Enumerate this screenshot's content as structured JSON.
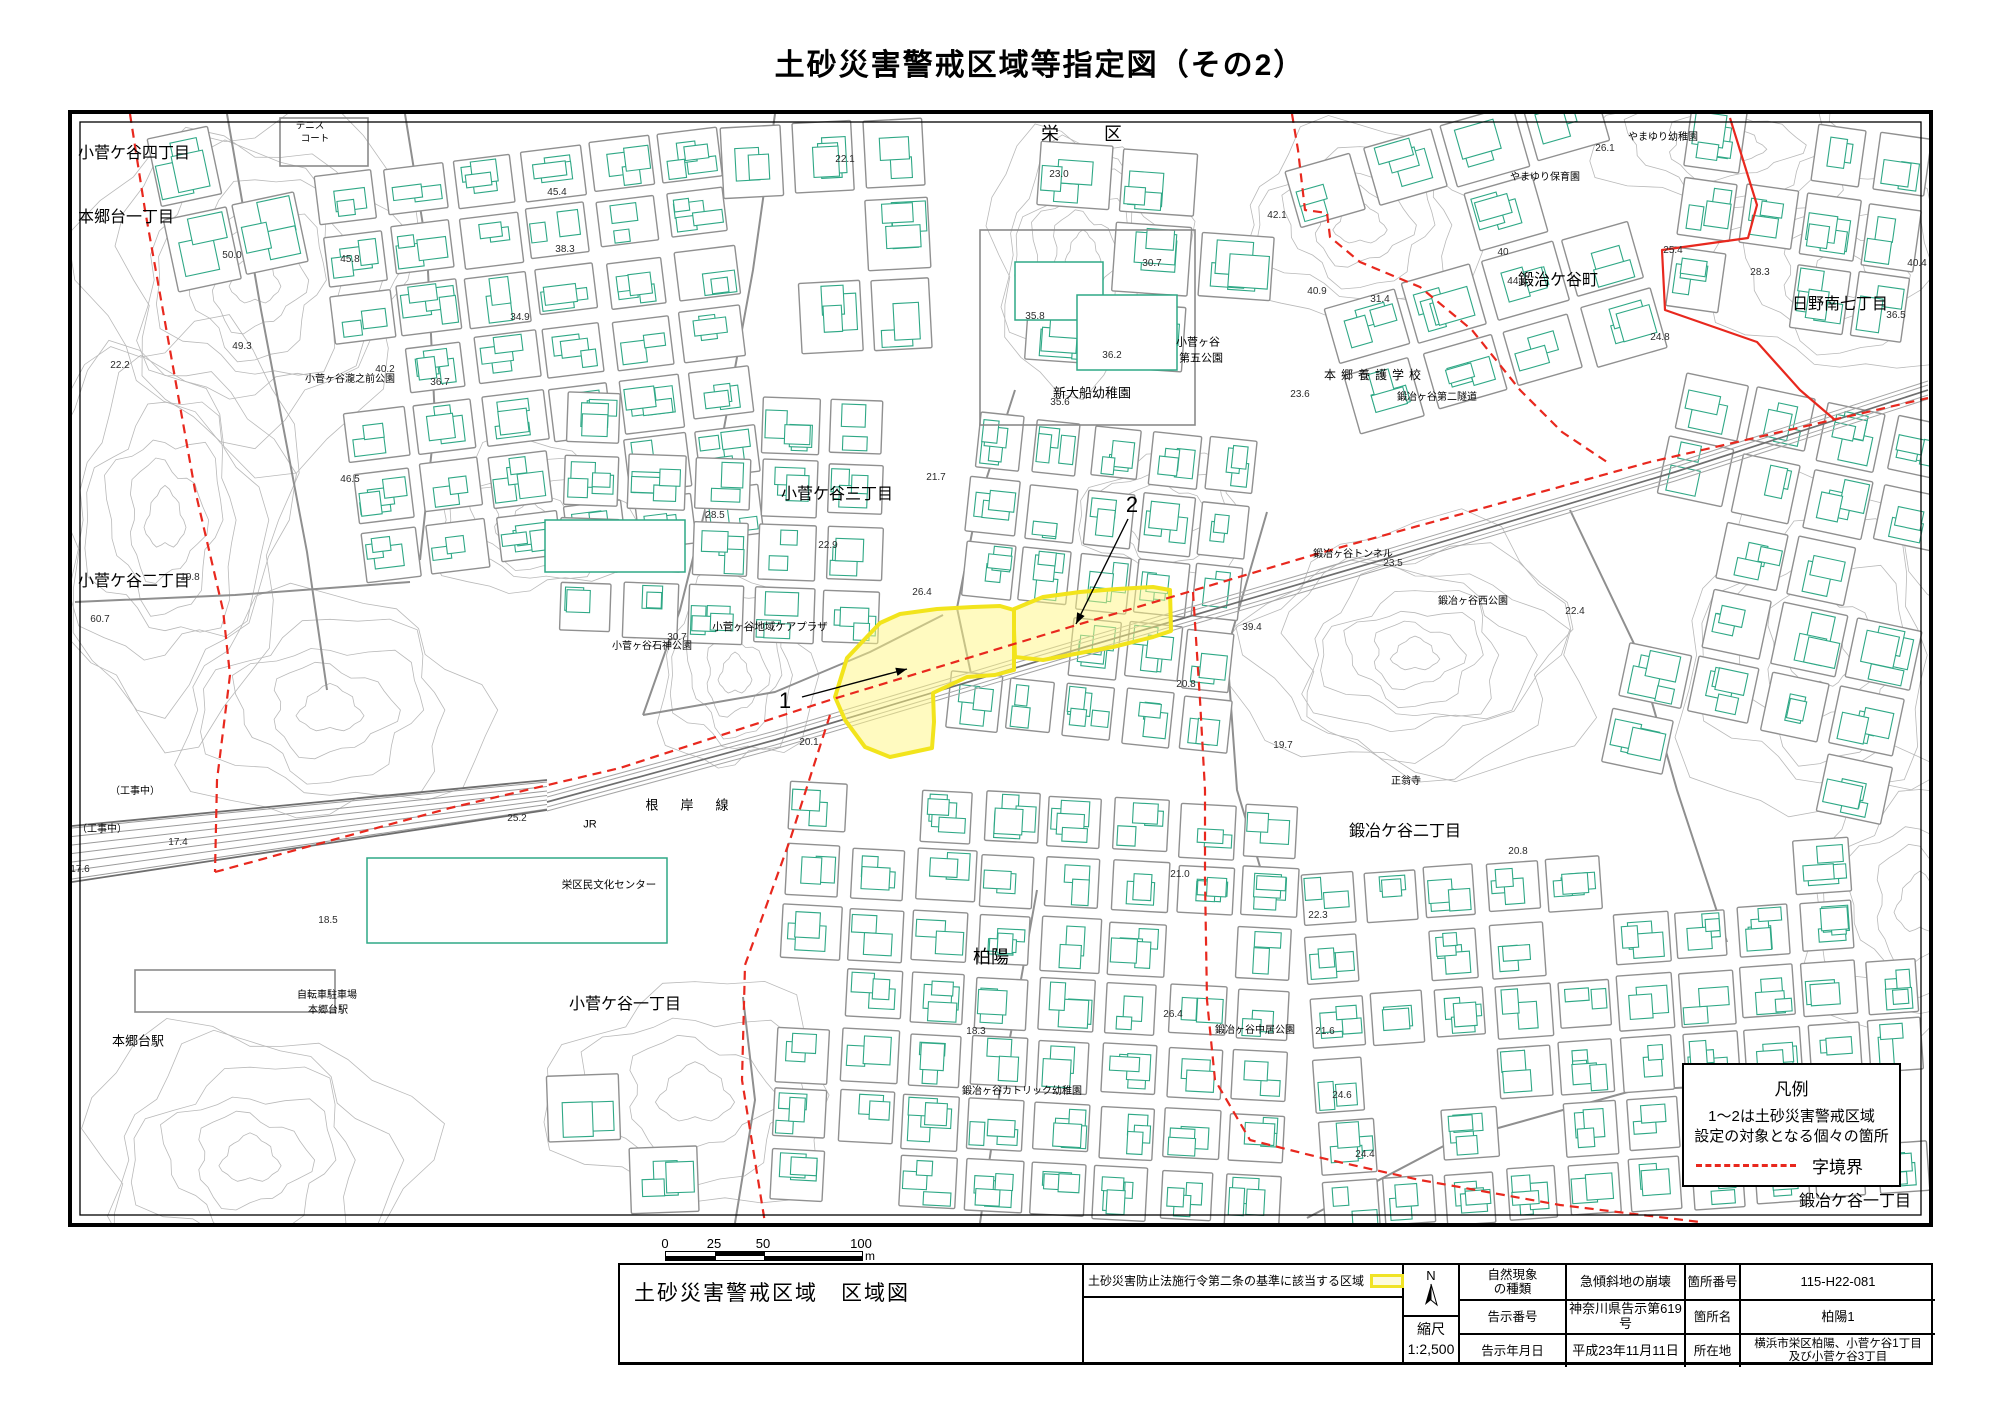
{
  "page_title": "土砂災害警戒区域等指定図（その2）",
  "colors": {
    "building": "#2fa886",
    "road": "#8f8f8f",
    "contour": "#b9b9b9",
    "rail": "#6e6e6e",
    "boundary_red": "#e8281e",
    "zone_fill": "rgba(255,246,130,0.5)",
    "zone_border": "#f2e41c"
  },
  "legend": {
    "title": "凡例",
    "line1": "1～2は土砂災害警戒区域",
    "line2": "設定の対象となる個々の箇所",
    "boundary_label": "字境界"
  },
  "scalebar": {
    "ticks": [
      "0",
      "25",
      "50",
      "100"
    ],
    "unit": "m"
  },
  "titleblock": {
    "map_title": "土砂災害警戒区域　区域図",
    "criteria": "土砂災害防止法施行令第二条の基準に該当する区域",
    "north": "N",
    "scale_label": "縮尺",
    "scale_value": "1:2,500",
    "rows": [
      {
        "k1": "自然現象\nの種類",
        "v1": "急傾斜地の崩壊",
        "k2": "箇所番号",
        "v2": "115-H22-081"
      },
      {
        "k1": "告示番号",
        "v1": "神奈川県告示第619号",
        "k2": "箇所名",
        "v2": "柏陽1"
      },
      {
        "k1": "告示年月日",
        "v1": "平成23年11月11日",
        "k2": "所在地",
        "v2": "横浜市栄区柏陽、小菅ケ谷1丁目\n及び小菅ケ谷3丁目"
      }
    ]
  },
  "map": {
    "area_labels": [
      {
        "t": "小菅ケ谷四丁目",
        "x": 6,
        "y": 40,
        "s": 16,
        "a": "l"
      },
      {
        "t": "本郷台一丁目",
        "x": 6,
        "y": 104,
        "s": 16,
        "a": "l"
      },
      {
        "t": "小菅ケ谷二丁目",
        "x": 6,
        "y": 468,
        "s": 16,
        "a": "l"
      },
      {
        "t": "小菅ケ谷三丁目",
        "x": 765,
        "y": 381,
        "s": 16
      },
      {
        "t": "栄区",
        "x": 1032,
        "y": 20,
        "s": 18,
        "ls": 45
      },
      {
        "t": "鍛治ケ谷町",
        "x": 1486,
        "y": 167,
        "s": 16
      },
      {
        "t": "日野南七丁目",
        "x": 1768,
        "y": 191,
        "s": 16
      },
      {
        "t": "鍛冶ケ谷二丁目",
        "x": 1333,
        "y": 718,
        "s": 16
      },
      {
        "t": "柏陽",
        "x": 919,
        "y": 843,
        "s": 18
      },
      {
        "t": "小菅ケ谷一丁目",
        "x": 553,
        "y": 891,
        "s": 16
      },
      {
        "t": "鍛冶ケ谷一丁目",
        "x": 1783,
        "y": 1088,
        "s": 16
      },
      {
        "t": "本郷台駅",
        "x": 66,
        "y": 927,
        "s": 13
      }
    ],
    "spot_labels": [
      {
        "t": "テニス",
        "x": 238,
        "y": 12,
        "s": 9.5
      },
      {
        "t": "コート",
        "x": 243,
        "y": 25,
        "s": 9.5
      },
      {
        "t": "小菅ヶ谷瀧之前公園",
        "x": 278,
        "y": 266,
        "s": 10
      },
      {
        "t": "小菅ヶ谷地域ケアプラザ",
        "x": 698,
        "y": 513,
        "s": 10.5
      },
      {
        "t": "小菅ヶ谷石神公園",
        "x": 580,
        "y": 533,
        "s": 10
      },
      {
        "t": "新大船幼稚園",
        "x": 1020,
        "y": 279,
        "s": 13
      },
      {
        "t": "小菅ヶ谷",
        "x": 1126,
        "y": 229,
        "s": 11
      },
      {
        "t": "第五公園",
        "x": 1129,
        "y": 245,
        "s": 11
      },
      {
        "t": "本郷養護学校",
        "x": 1303,
        "y": 261,
        "s": 12,
        "ls": 5
      },
      {
        "t": "鍛冶ヶ谷第二隧道",
        "x": 1365,
        "y": 284,
        "s": 10
      },
      {
        "t": "やまゆり幼稚園",
        "x": 1591,
        "y": 24,
        "s": 10
      },
      {
        "t": "やまゆり保育園",
        "x": 1473,
        "y": 64,
        "s": 10
      },
      {
        "t": "鍛冶ヶ谷トンネル",
        "x": 1281,
        "y": 441,
        "s": 10
      },
      {
        "t": "鍛冶ヶ谷西公園",
        "x": 1401,
        "y": 488,
        "s": 10
      },
      {
        "t": "正翁寺",
        "x": 1334,
        "y": 668,
        "s": 10
      },
      {
        "t": "栄区民文化センター",
        "x": 537,
        "y": 771,
        "s": 10.5
      },
      {
        "t": "JR",
        "x": 518,
        "y": 711,
        "s": 11
      },
      {
        "t": "根岸線",
        "x": 626,
        "y": 691,
        "s": 13,
        "ls": 22
      },
      {
        "t": "自転車駐車場",
        "x": 255,
        "y": 882,
        "s": 10
      },
      {
        "t": "本郷台駅",
        "x": 256,
        "y": 897,
        "s": 10
      },
      {
        "t": "鍛冶ヶ谷中居公園",
        "x": 1183,
        "y": 917,
        "s": 10
      },
      {
        "t": "鍛冶ヶ谷カトリック幼稚園",
        "x": 950,
        "y": 978,
        "s": 10
      },
      {
        "t": "（工事中）",
        "x": 63,
        "y": 678,
        "s": 10
      },
      {
        "t": "（工事中）",
        "x": 30,
        "y": 716,
        "s": 10
      }
    ],
    "elevations": [
      [
        "22.1",
        773,
        46
      ],
      [
        "23.0",
        987,
        61
      ],
      [
        "45.4",
        485,
        79
      ],
      [
        "42.1",
        1205,
        102
      ],
      [
        "30.7",
        1080,
        150
      ],
      [
        "40.9",
        1245,
        178
      ],
      [
        "36.2",
        1040,
        242
      ],
      [
        "35.6",
        988,
        289
      ],
      [
        "35.8",
        963,
        203
      ],
      [
        "26.1",
        1533,
        35
      ],
      [
        "25.4",
        1601,
        137
      ],
      [
        "28.3",
        1688,
        159
      ],
      [
        "40.4",
        1845,
        150
      ],
      [
        "36.5",
        1824,
        202
      ],
      [
        "24.8",
        1588,
        224
      ],
      [
        "44.4",
        1445,
        168
      ],
      [
        "40",
        1431,
        139
      ],
      [
        "23.5",
        1321,
        450
      ],
      [
        "22.4",
        1503,
        498
      ],
      [
        "23.6",
        1228,
        281
      ],
      [
        "31.4",
        1308,
        186
      ],
      [
        "22.3",
        1246,
        802
      ],
      [
        "26.4",
        1101,
        901
      ],
      [
        "21.6",
        1253,
        918
      ],
      [
        "18.3",
        904,
        918
      ],
      [
        "24.4",
        1293,
        1041
      ],
      [
        "24.6",
        1270,
        982
      ],
      [
        "25.2",
        445,
        705
      ],
      [
        "18.5",
        256,
        807
      ],
      [
        "28.5",
        643,
        402
      ],
      [
        "22.9",
        756,
        432
      ],
      [
        "26.4",
        850,
        479
      ],
      [
        "21.7",
        864,
        364
      ],
      [
        "30.7",
        605,
        524
      ],
      [
        "20.1",
        737,
        629
      ],
      [
        "20.8",
        1446,
        738
      ],
      [
        "20.8",
        1114,
        571
      ],
      [
        "19.7",
        1211,
        632
      ],
      [
        "21.0",
        1108,
        761
      ],
      [
        "22.2",
        48,
        252
      ],
      [
        "49.3",
        170,
        233
      ],
      [
        "50.0",
        160,
        142
      ],
      [
        "40.2",
        313,
        256
      ],
      [
        "36.7",
        368,
        269
      ],
      [
        "34.9",
        448,
        204
      ],
      [
        "45.8",
        278,
        146
      ],
      [
        "38.3",
        493,
        136
      ],
      [
        "46.5",
        278,
        366
      ],
      [
        "19.8",
        118,
        464
      ],
      [
        "60.7",
        28,
        506
      ],
      [
        "17.4",
        106,
        729
      ],
      [
        "17.6",
        8,
        756
      ],
      [
        "39.4",
        1180,
        514
      ]
    ],
    "markers": [
      {
        "n": "1",
        "nx": 713,
        "ny": 587,
        "x1": 730,
        "y1": 583,
        "x2": 835,
        "y2": 555
      },
      {
        "n": "2",
        "nx": 1060,
        "ny": 391,
        "x1": 1056,
        "y1": 405,
        "x2": 1004,
        "y2": 510
      }
    ]
  }
}
